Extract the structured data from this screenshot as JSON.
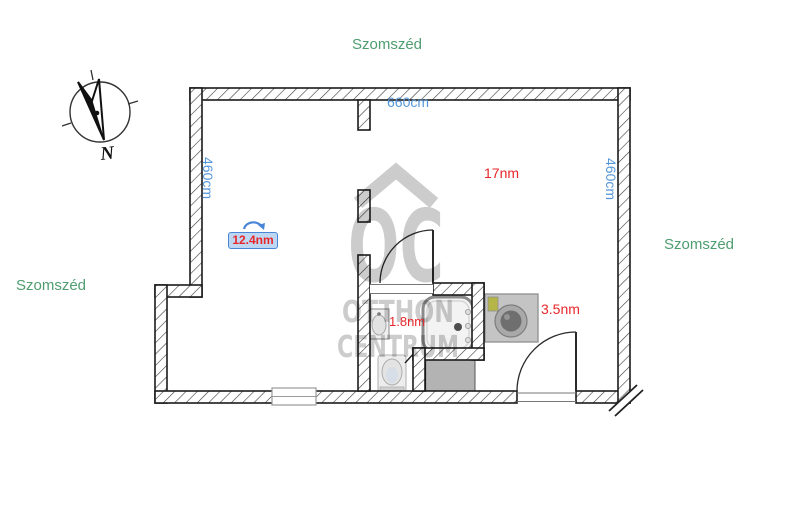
{
  "plan": {
    "neighbors": {
      "top": "Szomszéd",
      "left": "Szomszéd",
      "right": "Szomszéd"
    },
    "dimensions": {
      "top": "660cm",
      "left": "460cm",
      "right": "460cm"
    },
    "rooms": {
      "main": "17nm",
      "selected": "12.4nm",
      "bathroom": "1.8nm",
      "hall": "3.5nm"
    },
    "compass": {
      "north": "N"
    }
  },
  "watermark": {
    "monogram": "OC",
    "line1": "OTTHON",
    "line2": "CENTRUM"
  },
  "colors": {
    "neighbor-text": "#4f9d6f",
    "dimension-text": "#5596d8",
    "area-text": "#e8262a",
    "selection-border": "#4a86d8",
    "selection-bg": "#bdd7f3",
    "watermark-gray": "#bfbfbf",
    "wall-line": "#1b1b1b"
  }
}
